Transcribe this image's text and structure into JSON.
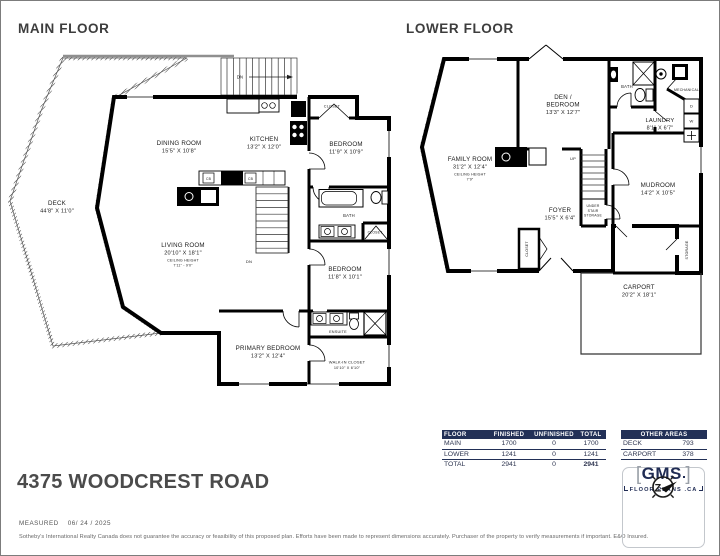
{
  "colors": {
    "navy": "#223057",
    "wall": "#000000",
    "title_gray": "#3d3d3d"
  },
  "main_floor": {
    "title": "MAIN FLOOR",
    "deck": {
      "name": "DECK",
      "dims": "44'8\" X 11'0\""
    },
    "dining": {
      "name": "DINING ROOM",
      "dims": "15'5\" X 10'8\""
    },
    "kitchen": {
      "name": "KITCHEN",
      "dims": "13'2\" X 12'0\""
    },
    "bedroom1": {
      "name": "BEDROOM",
      "dims": "11'9\" X 10'9\""
    },
    "living": {
      "name": "LIVING ROOM",
      "dims": "20'10\" X 18'1\"",
      "ch_label": "CEILING HEIGHT",
      "ch_value": "7'11\" - 9'0\""
    },
    "bedroom2": {
      "name": "BEDROOM",
      "dims": "11'8\" X 10'1\""
    },
    "primary": {
      "name": "PRIMARY BEDROOM",
      "dims": "13'2\" X 12'4\""
    },
    "walkin": {
      "name": "WALK-IN CLOSET",
      "dims": "10'10\" X 6'10\""
    },
    "bath": "BATH",
    "ensuite": "ENSUITE",
    "closet_top": "CLOSET",
    "closet_mid": "CLOSET",
    "dn": "DN",
    "cb": "CB"
  },
  "lower_floor": {
    "title": "LOWER FLOOR",
    "den": {
      "name1": "DEN /",
      "name2": "BEDROOM",
      "dims": "13'3\" X 12'7\""
    },
    "family": {
      "name": "FAMILY ROOM",
      "dims": "31'2\" X 12'4\"",
      "ch_label": "CEILING HEIGHT",
      "ch_value": "7'9\""
    },
    "foyer": {
      "name": "FOYER",
      "dims": "15'5\" X 6'4\""
    },
    "mudroom": {
      "name": "MUDROOM",
      "dims": "14'2\" X 10'5\""
    },
    "laundry": {
      "name": "LAUNDRY",
      "dims": "8'1\" X 6'7\""
    },
    "carport": {
      "name": "CARPORT",
      "dims": "20'2\" X 18'1\""
    },
    "bath": "BATH",
    "mechanical": "MECHANICAL",
    "understair": {
      "l1": "UNDER",
      "l2": "STAIR",
      "l3": "STORAGE"
    },
    "closet": "CLOSET",
    "storage": "STORAGE",
    "up": "UP",
    "washer": "W",
    "dryer": "D"
  },
  "area_table": {
    "headers": [
      "FLOOR",
      "FINISHED",
      "UNFINISHED",
      "TOTAL"
    ],
    "rows": [
      {
        "floor": "MAIN",
        "finished": "1700",
        "unfinished": "0",
        "total": "1700"
      },
      {
        "floor": "LOWER",
        "finished": "1241",
        "unfinished": "0",
        "total": "1241"
      },
      {
        "floor": "TOTAL",
        "finished": "2941",
        "unfinished": "0",
        "total": "2941"
      }
    ]
  },
  "other_areas": {
    "header": "OTHER AREAS",
    "rows": [
      {
        "name": "DECK",
        "value": "793"
      },
      {
        "name": "CARPORT",
        "value": "378"
      }
    ]
  },
  "address": "4375 WOODCREST ROAD",
  "measured": {
    "label": "MEASURED",
    "date": "06/ 24 / 2025"
  },
  "disclaimer": "Sotheby's International Realty Canada does not guarantee the accuracy or feasibility of this proposed plan.  Efforts have been made to represent dimensions accurately.  Purchaser of the property to verify measurements if important.  E&O Insured.",
  "logo": {
    "bracket_left": "[",
    "name": "GMS",
    "bracket_right": "]",
    "sub": "FLOOR PLANS .CA"
  }
}
